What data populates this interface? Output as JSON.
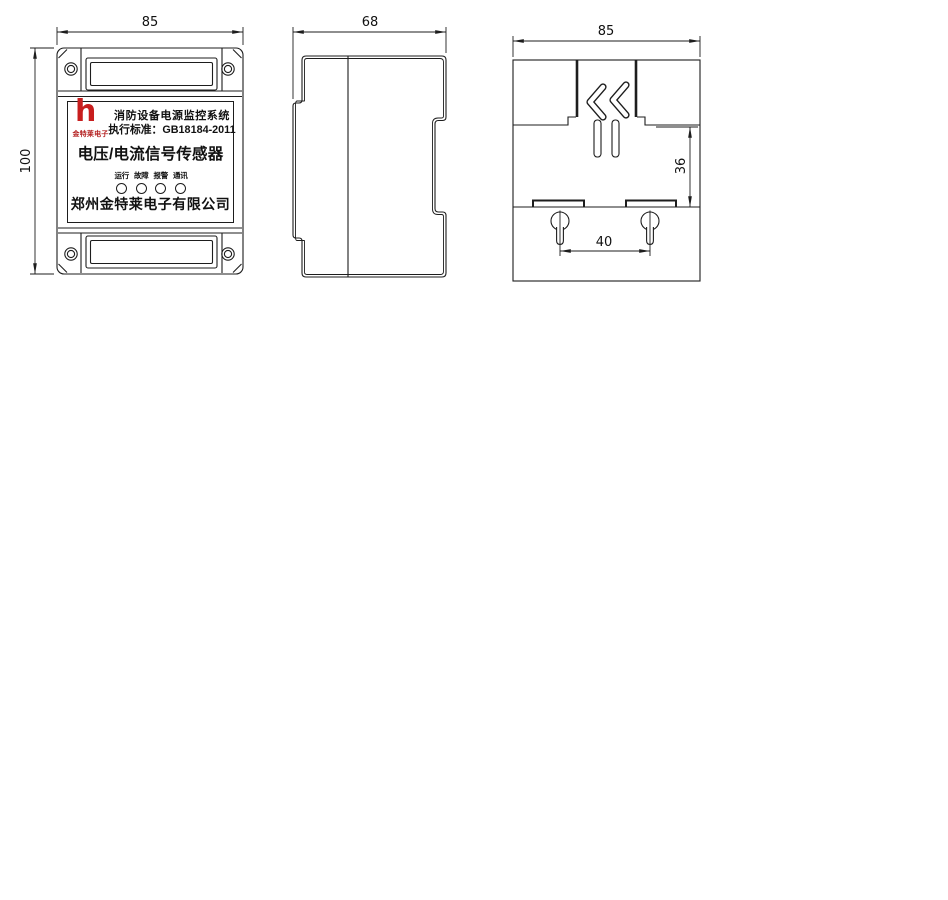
{
  "colors": {
    "line": "#1d1d1d",
    "logo_red": "#c81e1e",
    "background": "#ffffff"
  },
  "dims": {
    "front_width": "85",
    "front_height": "100",
    "side_depth": "68",
    "back_width": "85",
    "back_rail_height": "36",
    "back_hole_spacing": "40"
  },
  "label": {
    "logo_mark": "h",
    "logo_text": "金特莱电子",
    "line1": "消防设备电源监控系统",
    "line2": "执行标准：GB18184-2011",
    "title": "电压/电流信号传感器",
    "led_labels": [
      "运行",
      "故障",
      "报警",
      "通讯"
    ],
    "company": "郑州金特莱电子有限公司"
  }
}
